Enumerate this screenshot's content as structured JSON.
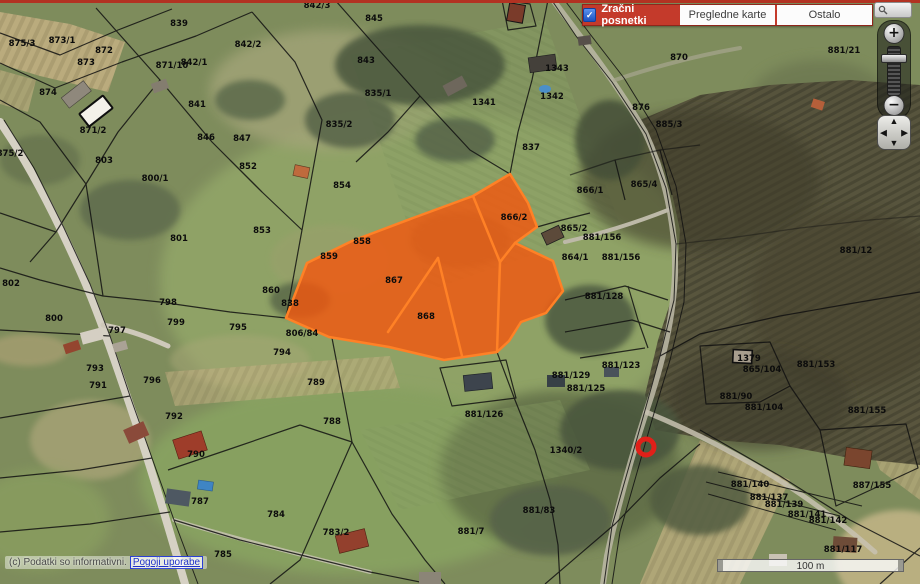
{
  "header": {
    "tabs": [
      {
        "label": "Zračni posnetki",
        "active": true
      },
      {
        "label": "Pregledne karte",
        "active": false
      },
      {
        "label": "Ostalo",
        "active": false
      }
    ],
    "active_tab_color": "#c43a2b"
  },
  "icons": {
    "check": "✓",
    "zoom_in": "+",
    "zoom_out": "−",
    "pan_up": "▲",
    "pan_down": "▼",
    "pan_left": "◀",
    "pan_right": "▶"
  },
  "search": {
    "value": ""
  },
  "footer": {
    "copyright": "(c) Podatki so informativni.",
    "terms_link": "Pogoji uporabe",
    "scale_label": "100 m"
  },
  "map": {
    "highlight_fill": "#f4560e",
    "highlight_stroke": "#ff8126",
    "marker_color": "#e02019",
    "boundary_color": "#111111",
    "parcel_labels": [
      {
        "t": "875/3",
        "x": 22,
        "y": 44
      },
      {
        "t": "873/1",
        "x": 62,
        "y": 41
      },
      {
        "t": "872",
        "x": 104,
        "y": 51
      },
      {
        "t": "873",
        "x": 86,
        "y": 63
      },
      {
        "t": "874",
        "x": 48,
        "y": 93
      },
      {
        "t": "875/2",
        "x": 10,
        "y": 154
      },
      {
        "t": "871/2",
        "x": 93,
        "y": 131
      },
      {
        "t": "871/10",
        "x": 172,
        "y": 66
      },
      {
        "t": "839",
        "x": 179,
        "y": 24
      },
      {
        "t": "842/1",
        "x": 194,
        "y": 63
      },
      {
        "t": "842/2",
        "x": 248,
        "y": 45
      },
      {
        "t": "841",
        "x": 197,
        "y": 105
      },
      {
        "t": "846",
        "x": 206,
        "y": 138
      },
      {
        "t": "847",
        "x": 242,
        "y": 139
      },
      {
        "t": "842/3",
        "x": 317,
        "y": 6
      },
      {
        "t": "845",
        "x": 374,
        "y": 19
      },
      {
        "t": "843",
        "x": 366,
        "y": 61
      },
      {
        "t": "835/1",
        "x": 378,
        "y": 94
      },
      {
        "t": "835/2",
        "x": 339,
        "y": 125
      },
      {
        "t": "1341",
        "x": 484,
        "y": 103
      },
      {
        "t": "1343",
        "x": 557,
        "y": 69
      },
      {
        "t": "1342",
        "x": 552,
        "y": 97
      },
      {
        "t": "837",
        "x": 531,
        "y": 148
      },
      {
        "t": "870",
        "x": 679,
        "y": 58
      },
      {
        "t": "881/21",
        "x": 844,
        "y": 51
      },
      {
        "t": "876",
        "x": 641,
        "y": 108
      },
      {
        "t": "885/3",
        "x": 669,
        "y": 125
      },
      {
        "t": "803",
        "x": 104,
        "y": 161
      },
      {
        "t": "800/1",
        "x": 155,
        "y": 179
      },
      {
        "t": "852",
        "x": 248,
        "y": 167
      },
      {
        "t": "853",
        "x": 262,
        "y": 231
      },
      {
        "t": "801",
        "x": 179,
        "y": 239
      },
      {
        "t": "854",
        "x": 342,
        "y": 186
      },
      {
        "t": "858",
        "x": 362,
        "y": 242
      },
      {
        "t": "859",
        "x": 329,
        "y": 257
      },
      {
        "t": "860",
        "x": 271,
        "y": 291
      },
      {
        "t": "838",
        "x": 290,
        "y": 304
      },
      {
        "t": "866/2",
        "x": 514,
        "y": 218
      },
      {
        "t": "867",
        "x": 394,
        "y": 281
      },
      {
        "t": "868",
        "x": 426,
        "y": 317
      },
      {
        "t": "866/1",
        "x": 590,
        "y": 191
      },
      {
        "t": "865/4",
        "x": 644,
        "y": 185
      },
      {
        "t": "865/2",
        "x": 574,
        "y": 229
      },
      {
        "t": "881/156",
        "x": 602,
        "y": 238
      },
      {
        "t": "864/1",
        "x": 575,
        "y": 258
      },
      {
        "t": "881/156",
        "x": 621,
        "y": 258
      },
      {
        "t": "881/12",
        "x": 856,
        "y": 251
      },
      {
        "t": "881/128",
        "x": 604,
        "y": 297
      },
      {
        "t": "806/84",
        "x": 302,
        "y": 334
      },
      {
        "t": "802",
        "x": 11,
        "y": 284
      },
      {
        "t": "800",
        "x": 54,
        "y": 319
      },
      {
        "t": "798",
        "x": 168,
        "y": 303
      },
      {
        "t": "799",
        "x": 176,
        "y": 323
      },
      {
        "t": "797",
        "x": 117,
        "y": 331
      },
      {
        "t": "795",
        "x": 238,
        "y": 328
      },
      {
        "t": "794",
        "x": 282,
        "y": 353
      },
      {
        "t": "793",
        "x": 95,
        "y": 369
      },
      {
        "t": "796",
        "x": 152,
        "y": 381
      },
      {
        "t": "791",
        "x": 98,
        "y": 386
      },
      {
        "t": "792",
        "x": 174,
        "y": 417
      },
      {
        "t": "789",
        "x": 316,
        "y": 383
      },
      {
        "t": "788",
        "x": 332,
        "y": 422
      },
      {
        "t": "790",
        "x": 196,
        "y": 455
      },
      {
        "t": "787",
        "x": 200,
        "y": 502
      },
      {
        "t": "784",
        "x": 276,
        "y": 515
      },
      {
        "t": "783/2",
        "x": 336,
        "y": 533
      },
      {
        "t": "785",
        "x": 223,
        "y": 555
      },
      {
        "t": "881/129",
        "x": 571,
        "y": 376
      },
      {
        "t": "881/123",
        "x": 621,
        "y": 366
      },
      {
        "t": "881/125",
        "x": 586,
        "y": 389
      },
      {
        "t": "881/126",
        "x": 484,
        "y": 415
      },
      {
        "t": "1340/2",
        "x": 566,
        "y": 451
      },
      {
        "t": "881/7",
        "x": 471,
        "y": 532
      },
      {
        "t": "881/83",
        "x": 539,
        "y": 511
      },
      {
        "t": "1379",
        "x": 749,
        "y": 359
      },
      {
        "t": "865/104",
        "x": 762,
        "y": 370
      },
      {
        "t": "881/153",
        "x": 816,
        "y": 365
      },
      {
        "t": "881/90",
        "x": 736,
        "y": 397
      },
      {
        "t": "881/104",
        "x": 764,
        "y": 408
      },
      {
        "t": "881/155",
        "x": 867,
        "y": 411
      },
      {
        "t": "887/155",
        "x": 872,
        "y": 486
      },
      {
        "t": "881/140",
        "x": 750,
        "y": 485
      },
      {
        "t": "881/137",
        "x": 769,
        "y": 498
      },
      {
        "t": "881/139",
        "x": 784,
        "y": 505
      },
      {
        "t": "881/141",
        "x": 807,
        "y": 515
      },
      {
        "t": "881/142",
        "x": 828,
        "y": 521
      },
      {
        "t": "881/117",
        "x": 843,
        "y": 550
      }
    ]
  }
}
